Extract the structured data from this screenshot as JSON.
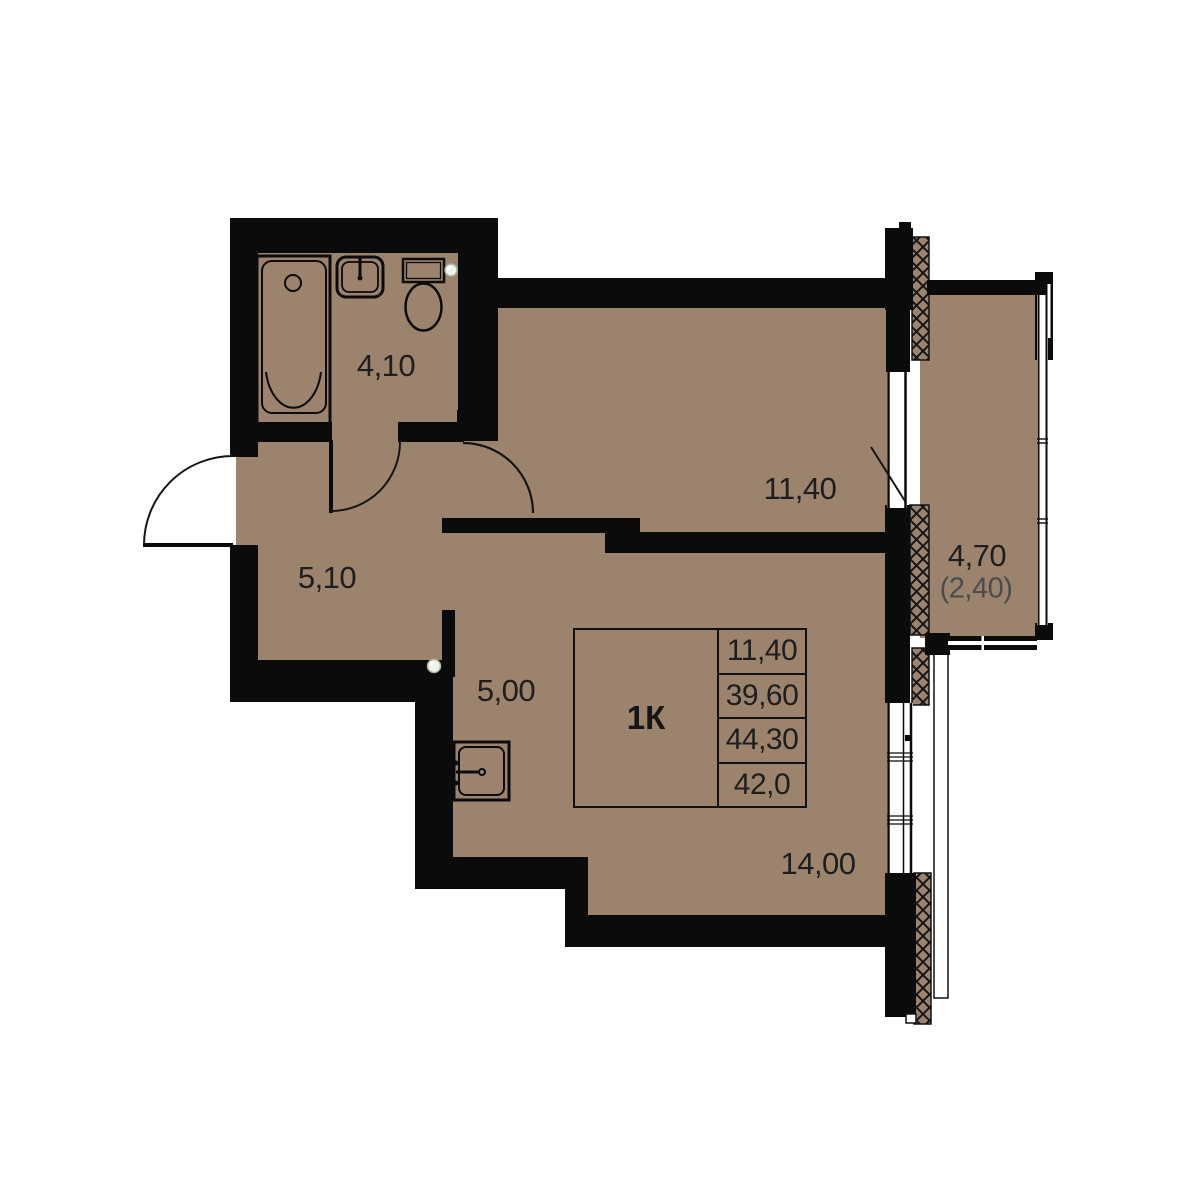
{
  "plan": {
    "type": "apartment-floor-plan",
    "unit_label": "1К",
    "rooms": [
      {
        "id": "bathroom",
        "area": "4,10"
      },
      {
        "id": "hallway",
        "area": "5,10"
      },
      {
        "id": "kitchen",
        "area": "5,00"
      },
      {
        "id": "bedroom",
        "area": "11,40"
      },
      {
        "id": "living",
        "area": "14,00"
      },
      {
        "id": "balcony",
        "area": "4,70",
        "area_reduced": "(2,40)"
      }
    ],
    "info_table": {
      "unit": "1К",
      "rows": [
        "11,40",
        "39,60",
        "44,30",
        "42,0"
      ]
    },
    "fixtures": [
      "bathtub",
      "washbasin",
      "toilet",
      "kitchen-sink"
    ],
    "colors": {
      "floor": "#9c836d",
      "wall": "#0b0b0b",
      "text": "#1e1e1e",
      "muted_text": "#4c4c4c",
      "background": "#ffffff"
    }
  }
}
